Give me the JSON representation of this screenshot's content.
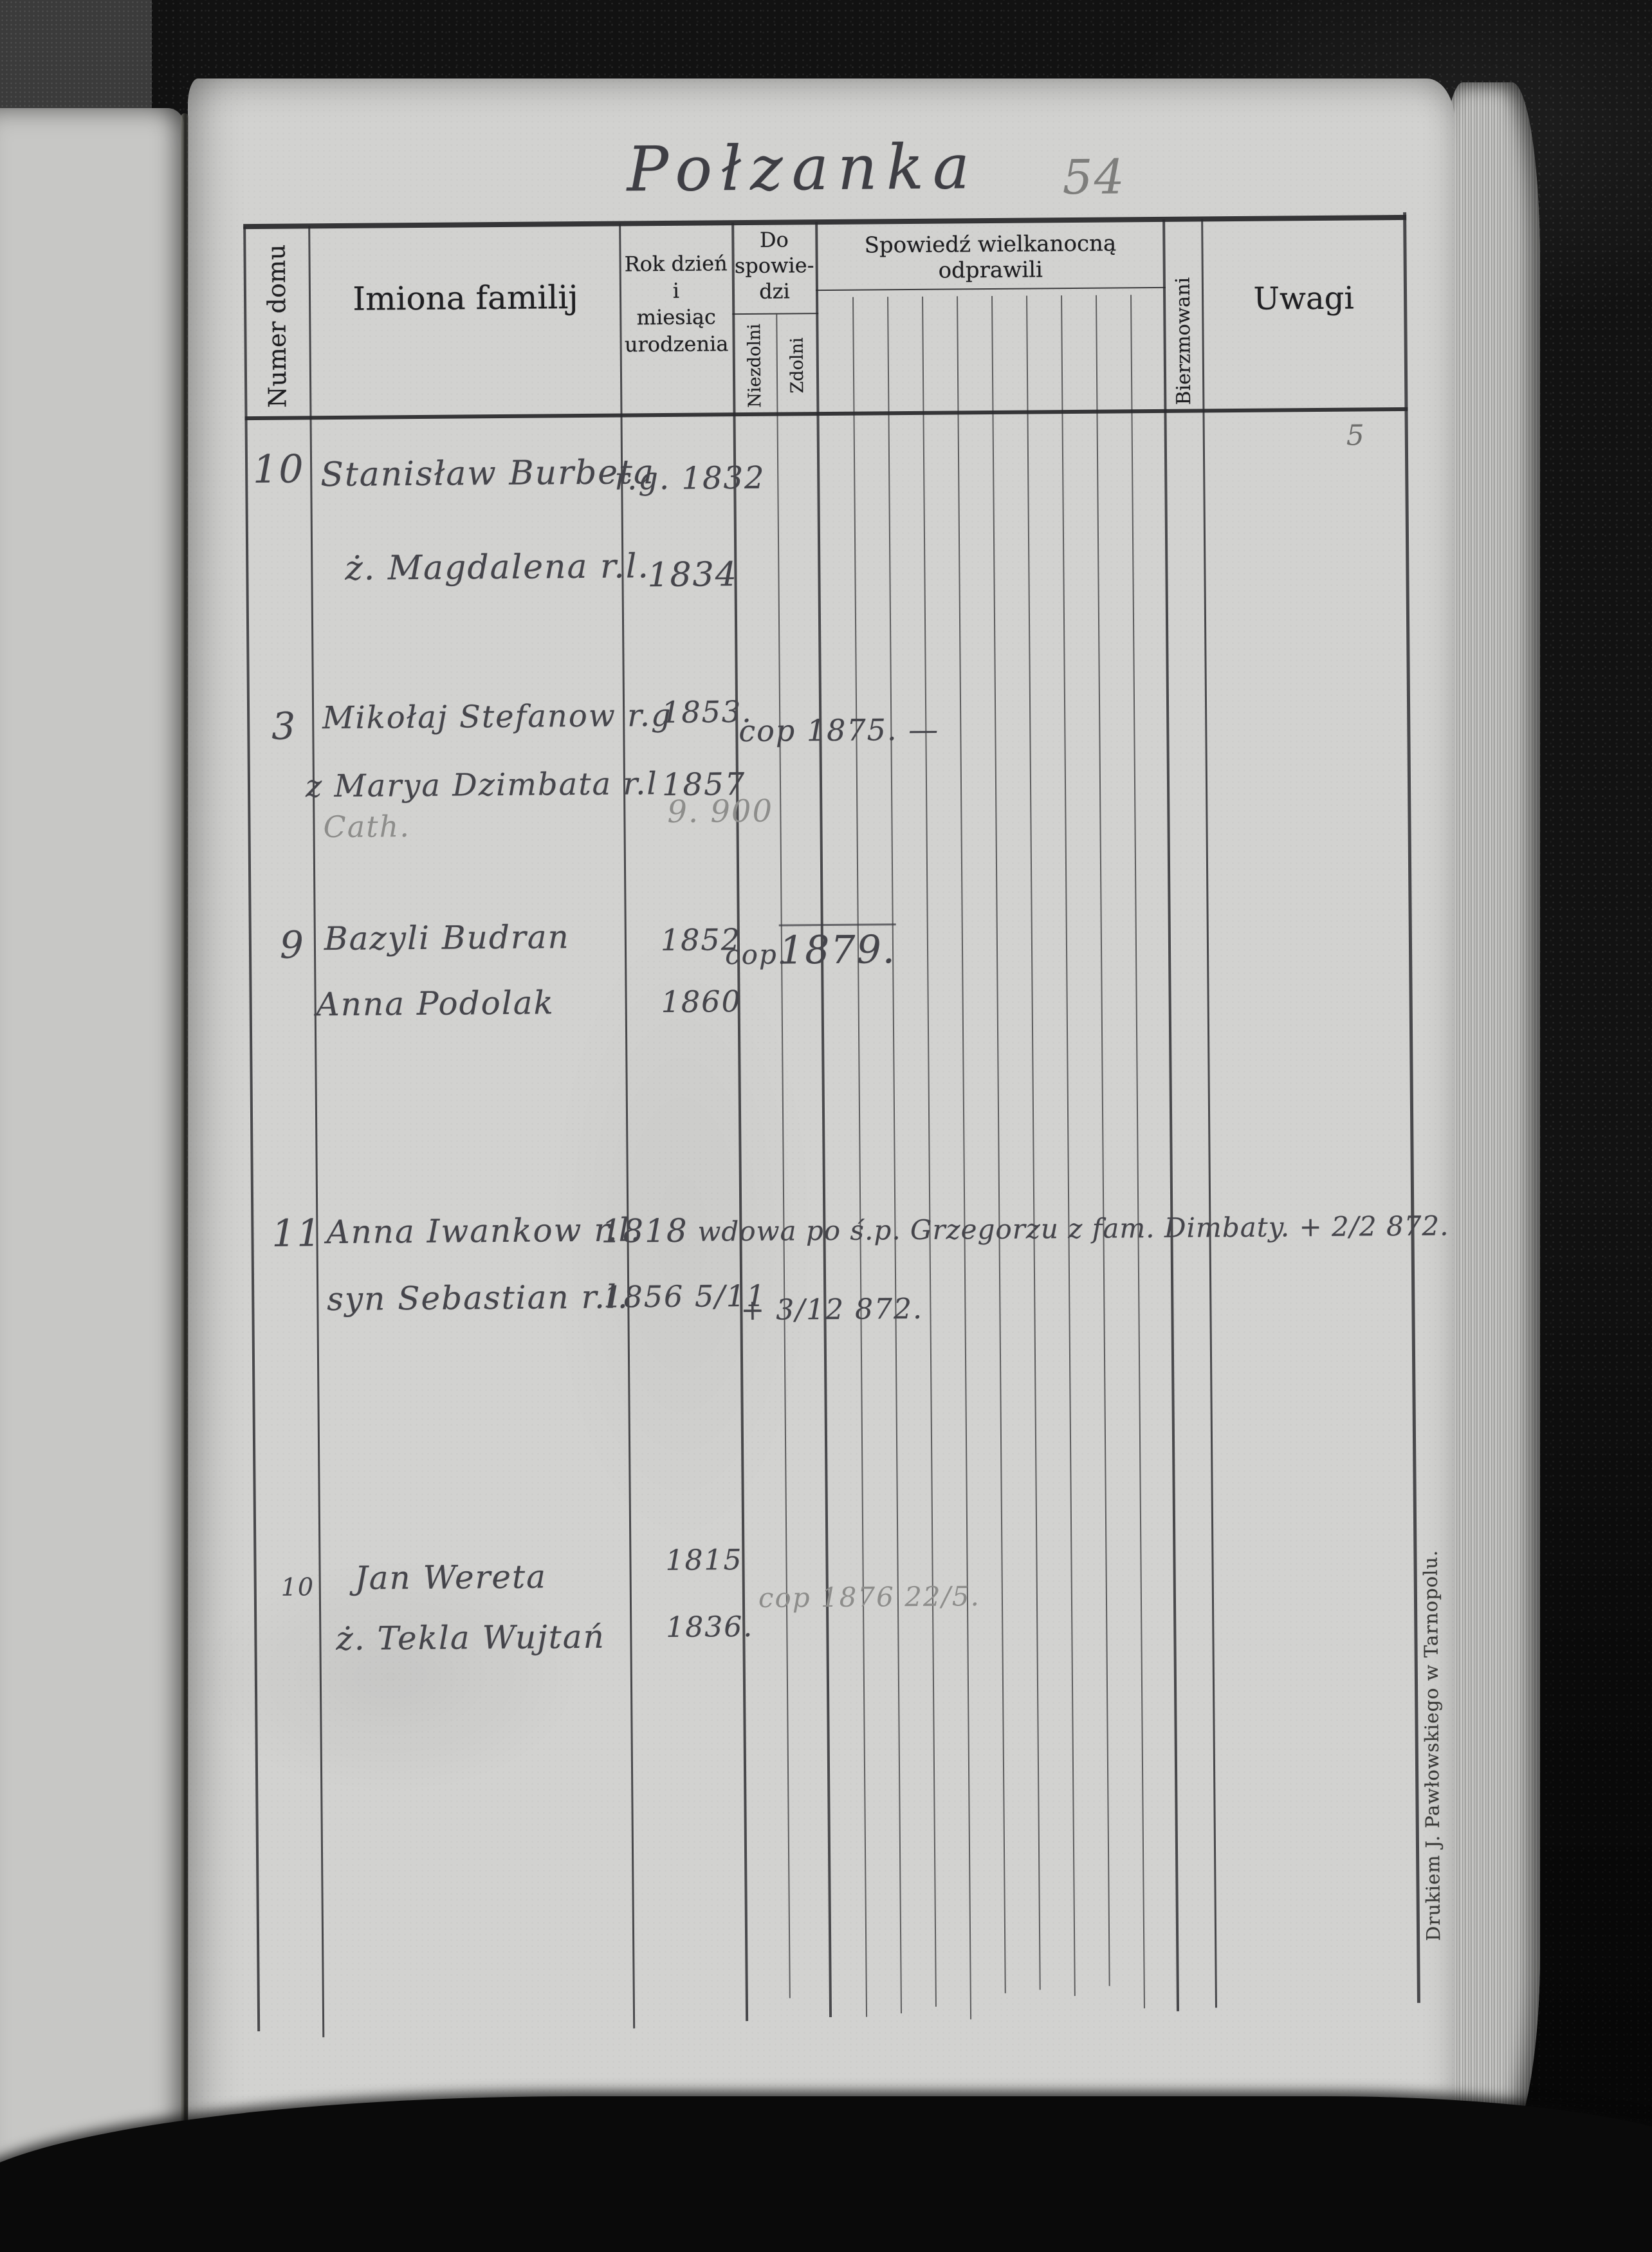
{
  "page": {
    "title": "Połzanka",
    "number": "54",
    "printer_imprint": "Drukiem J. Pawłowskiego w Tarnopolu."
  },
  "header": {
    "numer_domu": "Numer domu",
    "imiona_familij": "Imiona familij",
    "rok": "Rok dzień\ni\nmiesiąc\nurodzenia",
    "do_spowiedzi": "Do\nspowie-\ndzi",
    "niezdolni": "Niezdolni",
    "zdolni": "Zdolni",
    "spowiedz": "Spowiedź wielkanocną odprawili",
    "bierzmowani": "Bierzmowani",
    "uwagi": "Uwagi"
  },
  "entries": [
    {
      "house": "10",
      "l1_name": "Stanisław Burbeta",
      "l1_year": "r.g. 1832",
      "l2_name": "ż. Magdalena r.l.",
      "l2_year": "1834"
    },
    {
      "house": "3",
      "l1_name": "Mikołaj Stefanow r.g",
      "l1_year": "1853.",
      "l1_note": "cop 1875. —",
      "l2_name": "z Marya Dzimbata r.l",
      "l2_year": "1857",
      "pencil_a": "Cath.",
      "pencil_b": "9. 900"
    },
    {
      "house": "9",
      "l1_name": "Bazyli Budran",
      "l1_year": "1852",
      "l1_note": "cop.",
      "l1_note2": "1879.",
      "l2_name": "Anna Podolak",
      "l2_year": "1860"
    },
    {
      "house": "11",
      "l1_name": "Anna Iwankow r.l.",
      "l1_year": "1818",
      "l1_note": "wdowa po ś.p. Grzegorzu z fam. Dimbaty. + 2/2 872.",
      "l2_name": "syn Sebastian r.l.",
      "l2_year": "1856 5/11",
      "l2_note": "+ 3/12 872."
    },
    {
      "house": "10",
      "l1_name": "Jan Wereta",
      "l1_year": "1815",
      "l2_name": "ż. Tekla Wujtań",
      "l2_year": "1836.",
      "pencil_a": "cop 1876 22/5."
    }
  ],
  "marks": {
    "uwagi_note": "5"
  },
  "colors": {
    "paper": "#d2d2d0",
    "leather_background": "#121212",
    "table_line": "#2b2b2e",
    "printed_text": "#1f1f22",
    "ink": "#45454b",
    "pencil": "#8d8d8b"
  }
}
